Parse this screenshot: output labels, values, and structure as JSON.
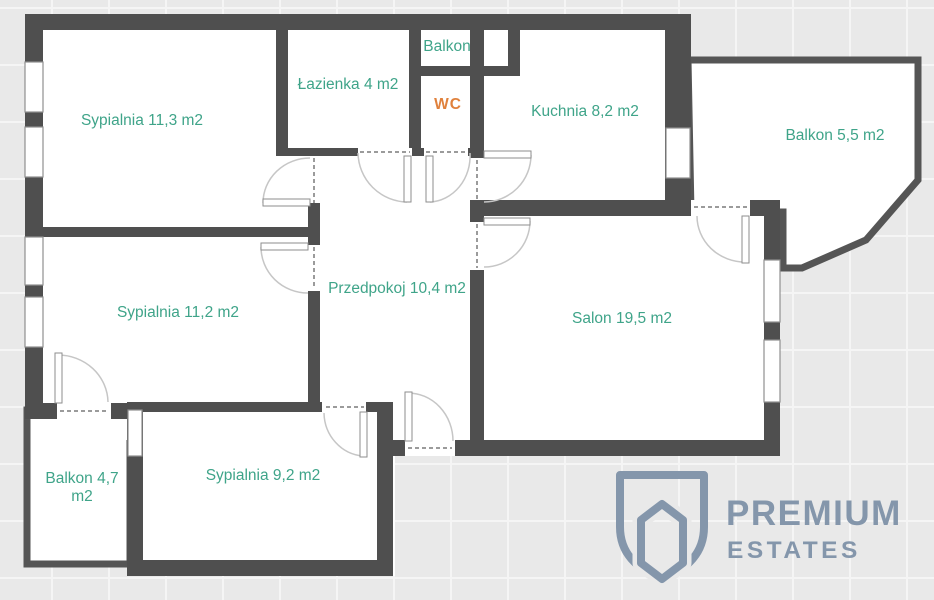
{
  "rooms": [
    {
      "name": "sypialnia-11-3",
      "label": "Sypialnia 11,3 m2"
    },
    {
      "name": "lazienka",
      "label": "Łazienka 4 m2"
    },
    {
      "name": "balkon-gorny",
      "label": "Balkon"
    },
    {
      "name": "wc",
      "label": "WC"
    },
    {
      "name": "kuchnia",
      "label": "Kuchnia 8,2 m2"
    },
    {
      "name": "balkon-prawy",
      "label": "Balkon 5,5 m2"
    },
    {
      "name": "sypialnia-11-2",
      "label": "Sypialnia 11,2 m2"
    },
    {
      "name": "przedpokoj",
      "label": "Przedpokoj 10,4 m2"
    },
    {
      "name": "salon",
      "label": "Salon 19,5 m2"
    },
    {
      "name": "balkon-dolny",
      "label": "Balkon 4,7 m2"
    },
    {
      "name": "sypialnia-9-2",
      "label": "Sypialnia 9,2 m2"
    }
  ],
  "logo": {
    "line1": "PREMIUM",
    "line2": "ESTATES",
    "color": "#8496ab"
  },
  "colors": {
    "room_label": "#3fa489",
    "wc_label": "#e0813c",
    "wall": "#4f4f4f",
    "balcony_wall": "#555555",
    "floor": "#ffffff",
    "background": "#e9e9e9"
  }
}
